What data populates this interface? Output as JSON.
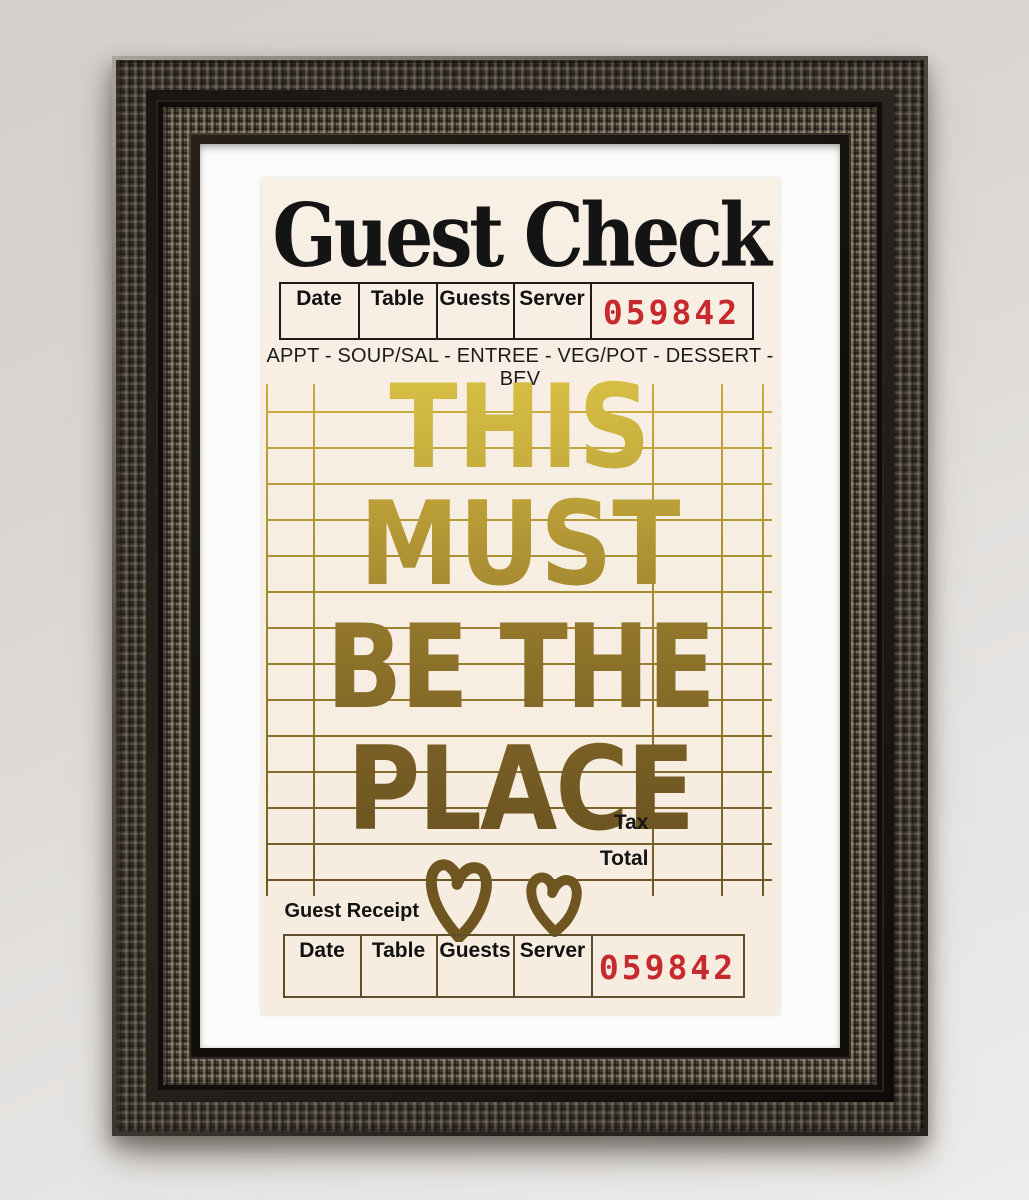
{
  "wall": {
    "color_top": "#d3cfcc",
    "color_bottom": "#eeecea",
    "frame_style": "ornate dark bronze-silver picture frame with white mat"
  },
  "poster": {
    "title": "Guest Check",
    "header": {
      "columns": [
        "Date",
        "Table",
        "Guests",
        "Server"
      ],
      "check_number": "059842"
    },
    "category_line": "APPT - SOUP/SAL - ENTREE - VEG/POT - DESSERT - BEV",
    "message_lines": [
      "THIS",
      "MUST",
      "BE THE",
      "PLACE"
    ],
    "totals": {
      "tax_label": "Tax",
      "total_label": "Total"
    },
    "receipt": {
      "label": "Guest Receipt",
      "columns": [
        "Date",
        "Table",
        "Guests",
        "Server"
      ],
      "check_number": "059842"
    },
    "icons": [
      "heart-icon-large",
      "heart-icon-small"
    ],
    "colors": {
      "paper": "#f7eee4",
      "check_number_red": "#c62a2c",
      "gold_bright": "#d9c246",
      "gold_dark": "#6a5220",
      "grid_line_top": "#c9ab3a",
      "grid_line_bottom": "#6e5926",
      "header_table_border": "#1c1c1c",
      "receipt_table_border": "#5f4e2b"
    }
  }
}
